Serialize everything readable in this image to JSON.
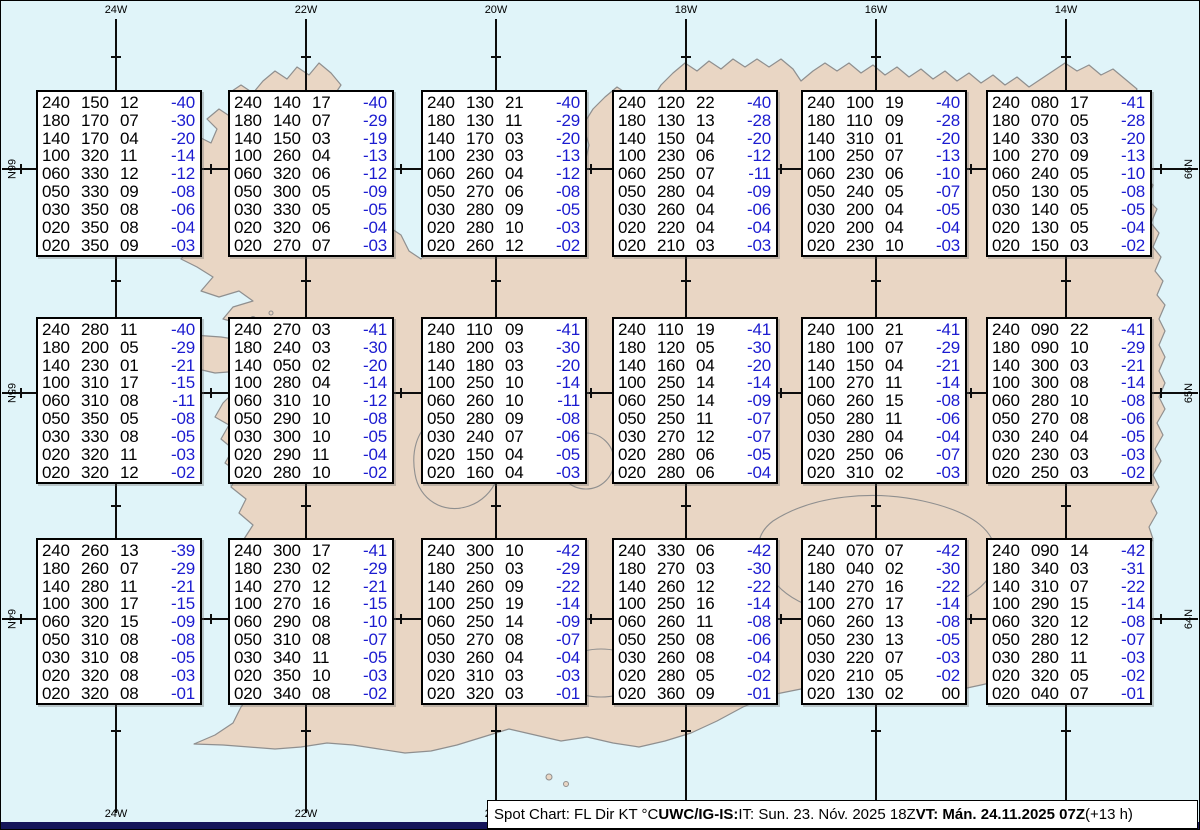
{
  "colors": {
    "sea": "#e0f4f9",
    "land": "#e9d6c4",
    "coastline": "#8f8f8f",
    "graticule": "#0d0d0d",
    "temperature_blue": "#1b1bd0",
    "footer_strip_navy": "#15155a",
    "box_background": "#ffffff"
  },
  "graticule": {
    "meridians": [
      {
        "label": "24W",
        "x": 115
      },
      {
        "label": "22W",
        "x": 305
      },
      {
        "label": "20W",
        "x": 495
      },
      {
        "label": "18W",
        "x": 685
      },
      {
        "label": "16W",
        "x": 875
      },
      {
        "label": "14W",
        "x": 1065
      }
    ],
    "parallels": [
      {
        "label": "66N",
        "y": 168
      },
      {
        "label": "65N",
        "y": 392
      },
      {
        "label": "64N",
        "y": 618
      }
    ]
  },
  "chart_data": {
    "type": "table",
    "title": "Spot Chart: FL Dir KT °C over Iceland",
    "columns": [
      "FL",
      "Dir",
      "KT",
      "°C"
    ],
    "flight_levels": [
      "240",
      "180",
      "140",
      "100",
      "060",
      "050",
      "030",
      "020",
      "020"
    ],
    "stations": [
      {
        "grid_row": 1,
        "grid_col": 1,
        "rows": [
          [
            "240",
            "150",
            "12",
            "-40"
          ],
          [
            "180",
            "170",
            "07",
            "-30"
          ],
          [
            "140",
            "170",
            "04",
            "-20"
          ],
          [
            "100",
            "320",
            "11",
            "-14"
          ],
          [
            "060",
            "330",
            "12",
            "-12"
          ],
          [
            "050",
            "330",
            "09",
            "-08"
          ],
          [
            "030",
            "350",
            "08",
            "-06"
          ],
          [
            "020",
            "350",
            "08",
            "-04"
          ],
          [
            "020",
            "350",
            "09",
            "-03"
          ]
        ]
      },
      {
        "grid_row": 1,
        "grid_col": 2,
        "rows": [
          [
            "240",
            "140",
            "17",
            "-40"
          ],
          [
            "180",
            "140",
            "07",
            "-29"
          ],
          [
            "140",
            "150",
            "03",
            "-19"
          ],
          [
            "100",
            "260",
            "04",
            "-13"
          ],
          [
            "060",
            "320",
            "06",
            "-12"
          ],
          [
            "050",
            "300",
            "05",
            "-09"
          ],
          [
            "030",
            "330",
            "05",
            "-05"
          ],
          [
            "020",
            "320",
            "06",
            "-04"
          ],
          [
            "020",
            "270",
            "07",
            "-03"
          ]
        ]
      },
      {
        "grid_row": 1,
        "grid_col": 3,
        "rows": [
          [
            "240",
            "130",
            "21",
            "-40"
          ],
          [
            "180",
            "130",
            "11",
            "-29"
          ],
          [
            "140",
            "170",
            "03",
            "-20"
          ],
          [
            "100",
            "230",
            "03",
            "-13"
          ],
          [
            "060",
            "260",
            "04",
            "-12"
          ],
          [
            "050",
            "270",
            "06",
            "-08"
          ],
          [
            "030",
            "280",
            "09",
            "-05"
          ],
          [
            "020",
            "280",
            "10",
            "-03"
          ],
          [
            "020",
            "260",
            "12",
            "-02"
          ]
        ]
      },
      {
        "grid_row": 1,
        "grid_col": 4,
        "rows": [
          [
            "240",
            "120",
            "22",
            "-40"
          ],
          [
            "180",
            "130",
            "13",
            "-28"
          ],
          [
            "140",
            "150",
            "04",
            "-20"
          ],
          [
            "100",
            "230",
            "06",
            "-12"
          ],
          [
            "060",
            "250",
            "07",
            "-11"
          ],
          [
            "050",
            "280",
            "04",
            "-09"
          ],
          [
            "030",
            "260",
            "04",
            "-06"
          ],
          [
            "020",
            "220",
            "04",
            "-04"
          ],
          [
            "020",
            "210",
            "03",
            "-03"
          ]
        ]
      },
      {
        "grid_row": 1,
        "grid_col": 5,
        "rows": [
          [
            "240",
            "100",
            "19",
            "-40"
          ],
          [
            "180",
            "110",
            "09",
            "-28"
          ],
          [
            "140",
            "310",
            "01",
            "-20"
          ],
          [
            "100",
            "250",
            "07",
            "-13"
          ],
          [
            "060",
            "230",
            "06",
            "-10"
          ],
          [
            "050",
            "240",
            "05",
            "-07"
          ],
          [
            "030",
            "200",
            "04",
            "-05"
          ],
          [
            "020",
            "200",
            "04",
            "-04"
          ],
          [
            "020",
            "230",
            "10",
            "-03"
          ]
        ]
      },
      {
        "grid_row": 1,
        "grid_col": 6,
        "rows": [
          [
            "240",
            "080",
            "17",
            "-41"
          ],
          [
            "180",
            "070",
            "05",
            "-28"
          ],
          [
            "140",
            "330",
            "03",
            "-20"
          ],
          [
            "100",
            "270",
            "09",
            "-13"
          ],
          [
            "060",
            "240",
            "05",
            "-10"
          ],
          [
            "050",
            "130",
            "05",
            "-08"
          ],
          [
            "030",
            "140",
            "05",
            "-05"
          ],
          [
            "020",
            "130",
            "05",
            "-04"
          ],
          [
            "020",
            "150",
            "03",
            "-02"
          ]
        ]
      },
      {
        "grid_row": 2,
        "grid_col": 1,
        "rows": [
          [
            "240",
            "280",
            "11",
            "-40"
          ],
          [
            "180",
            "200",
            "05",
            "-29"
          ],
          [
            "140",
            "230",
            "01",
            "-21"
          ],
          [
            "100",
            "310",
            "17",
            "-15"
          ],
          [
            "060",
            "310",
            "08",
            "-11"
          ],
          [
            "050",
            "350",
            "05",
            "-08"
          ],
          [
            "030",
            "330",
            "08",
            "-05"
          ],
          [
            "020",
            "320",
            "11",
            "-03"
          ],
          [
            "020",
            "320",
            "12",
            "-02"
          ]
        ]
      },
      {
        "grid_row": 2,
        "grid_col": 2,
        "rows": [
          [
            "240",
            "270",
            "03",
            "-41"
          ],
          [
            "180",
            "240",
            "03",
            "-30"
          ],
          [
            "140",
            "050",
            "02",
            "-20"
          ],
          [
            "100",
            "280",
            "04",
            "-14"
          ],
          [
            "060",
            "310",
            "10",
            "-12"
          ],
          [
            "050",
            "290",
            "10",
            "-08"
          ],
          [
            "030",
            "300",
            "10",
            "-05"
          ],
          [
            "020",
            "290",
            "11",
            "-04"
          ],
          [
            "020",
            "280",
            "10",
            "-02"
          ]
        ]
      },
      {
        "grid_row": 2,
        "grid_col": 3,
        "rows": [
          [
            "240",
            "110",
            "09",
            "-41"
          ],
          [
            "180",
            "200",
            "03",
            "-30"
          ],
          [
            "140",
            "180",
            "03",
            "-20"
          ],
          [
            "100",
            "250",
            "10",
            "-14"
          ],
          [
            "060",
            "260",
            "10",
            "-11"
          ],
          [
            "050",
            "280",
            "09",
            "-08"
          ],
          [
            "030",
            "240",
            "07",
            "-06"
          ],
          [
            "020",
            "150",
            "04",
            "-05"
          ],
          [
            "020",
            "160",
            "04",
            "-03"
          ]
        ]
      },
      {
        "grid_row": 2,
        "grid_col": 4,
        "rows": [
          [
            "240",
            "110",
            "19",
            "-41"
          ],
          [
            "180",
            "120",
            "05",
            "-30"
          ],
          [
            "140",
            "160",
            "04",
            "-20"
          ],
          [
            "100",
            "250",
            "14",
            "-14"
          ],
          [
            "060",
            "250",
            "14",
            "-09"
          ],
          [
            "050",
            "250",
            "11",
            "-07"
          ],
          [
            "030",
            "270",
            "12",
            "-07"
          ],
          [
            "020",
            "280",
            "06",
            "-05"
          ],
          [
            "020",
            "280",
            "06",
            "-04"
          ]
        ]
      },
      {
        "grid_row": 2,
        "grid_col": 5,
        "rows": [
          [
            "240",
            "100",
            "21",
            "-41"
          ],
          [
            "180",
            "100",
            "07",
            "-29"
          ],
          [
            "140",
            "150",
            "04",
            "-21"
          ],
          [
            "100",
            "270",
            "11",
            "-14"
          ],
          [
            "060",
            "260",
            "15",
            "-08"
          ],
          [
            "050",
            "280",
            "11",
            "-06"
          ],
          [
            "030",
            "280",
            "04",
            "-04"
          ],
          [
            "020",
            "250",
            "06",
            "-07"
          ],
          [
            "020",
            "310",
            "02",
            "-03"
          ]
        ]
      },
      {
        "grid_row": 2,
        "grid_col": 6,
        "rows": [
          [
            "240",
            "090",
            "22",
            "-41"
          ],
          [
            "180",
            "090",
            "10",
            "-29"
          ],
          [
            "140",
            "300",
            "03",
            "-21"
          ],
          [
            "100",
            "300",
            "08",
            "-14"
          ],
          [
            "060",
            "280",
            "10",
            "-08"
          ],
          [
            "050",
            "270",
            "08",
            "-06"
          ],
          [
            "030",
            "240",
            "04",
            "-05"
          ],
          [
            "020",
            "230",
            "03",
            "-03"
          ],
          [
            "020",
            "250",
            "03",
            "-02"
          ]
        ]
      },
      {
        "grid_row": 3,
        "grid_col": 1,
        "rows": [
          [
            "240",
            "260",
            "13",
            "-39"
          ],
          [
            "180",
            "260",
            "07",
            "-29"
          ],
          [
            "140",
            "280",
            "11",
            "-21"
          ],
          [
            "100",
            "300",
            "17",
            "-15"
          ],
          [
            "060",
            "320",
            "15",
            "-09"
          ],
          [
            "050",
            "310",
            "08",
            "-08"
          ],
          [
            "030",
            "310",
            "08",
            "-05"
          ],
          [
            "020",
            "320",
            "08",
            "-03"
          ],
          [
            "020",
            "320",
            "08",
            "-01"
          ]
        ]
      },
      {
        "grid_row": 3,
        "grid_col": 2,
        "rows": [
          [
            "240",
            "300",
            "17",
            "-41"
          ],
          [
            "180",
            "230",
            "02",
            "-29"
          ],
          [
            "140",
            "270",
            "12",
            "-21"
          ],
          [
            "100",
            "270",
            "16",
            "-15"
          ],
          [
            "060",
            "290",
            "08",
            "-10"
          ],
          [
            "050",
            "310",
            "08",
            "-07"
          ],
          [
            "030",
            "340",
            "11",
            "-05"
          ],
          [
            "020",
            "350",
            "10",
            "-03"
          ],
          [
            "020",
            "340",
            "08",
            "-02"
          ]
        ]
      },
      {
        "grid_row": 3,
        "grid_col": 3,
        "rows": [
          [
            "240",
            "300",
            "10",
            "-42"
          ],
          [
            "180",
            "250",
            "03",
            "-29"
          ],
          [
            "140",
            "260",
            "09",
            "-22"
          ],
          [
            "100",
            "250",
            "19",
            "-14"
          ],
          [
            "060",
            "250",
            "14",
            "-09"
          ],
          [
            "050",
            "270",
            "08",
            "-07"
          ],
          [
            "030",
            "260",
            "04",
            "-04"
          ],
          [
            "020",
            "310",
            "03",
            "-03"
          ],
          [
            "020",
            "320",
            "03",
            "-01"
          ]
        ]
      },
      {
        "grid_row": 3,
        "grid_col": 4,
        "rows": [
          [
            "240",
            "330",
            "06",
            "-42"
          ],
          [
            "180",
            "270",
            "03",
            "-30"
          ],
          [
            "140",
            "260",
            "12",
            "-22"
          ],
          [
            "100",
            "250",
            "16",
            "-14"
          ],
          [
            "060",
            "260",
            "11",
            "-08"
          ],
          [
            "050",
            "250",
            "08",
            "-06"
          ],
          [
            "030",
            "260",
            "08",
            "-04"
          ],
          [
            "020",
            "280",
            "05",
            "-02"
          ],
          [
            "020",
            "360",
            "09",
            "-01"
          ]
        ]
      },
      {
        "grid_row": 3,
        "grid_col": 5,
        "rows": [
          [
            "240",
            "070",
            "07",
            "-42"
          ],
          [
            "180",
            "040",
            "02",
            "-30"
          ],
          [
            "140",
            "270",
            "16",
            "-22"
          ],
          [
            "100",
            "270",
            "17",
            "-14"
          ],
          [
            "060",
            "260",
            "13",
            "-08"
          ],
          [
            "050",
            "230",
            "13",
            "-05"
          ],
          [
            "030",
            "220",
            "07",
            "-03"
          ],
          [
            "020",
            "210",
            "05",
            "-02"
          ],
          [
            "020",
            "130",
            "02",
            "00"
          ]
        ]
      },
      {
        "grid_row": 3,
        "grid_col": 6,
        "rows": [
          [
            "240",
            "090",
            "14",
            "-42"
          ],
          [
            "180",
            "340",
            "03",
            "-31"
          ],
          [
            "140",
            "310",
            "07",
            "-22"
          ],
          [
            "100",
            "290",
            "15",
            "-14"
          ],
          [
            "060",
            "320",
            "12",
            "-08"
          ],
          [
            "050",
            "280",
            "12",
            "-07"
          ],
          [
            "030",
            "280",
            "11",
            "-03"
          ],
          [
            "020",
            "320",
            "05",
            "-02"
          ],
          [
            "020",
            "040",
            "07",
            "-01"
          ]
        ]
      }
    ]
  },
  "footer": {
    "prefix": "Spot Chart: FL Dir KT °C ",
    "source_bold": "UWC/IG-IS:",
    "issue_time": " IT: Sun. 23. Nóv. 2025 18Z ",
    "valid_time_bold": "VT: Mán. 24.11.2025 07Z",
    "suffix": " (+13 h)"
  }
}
